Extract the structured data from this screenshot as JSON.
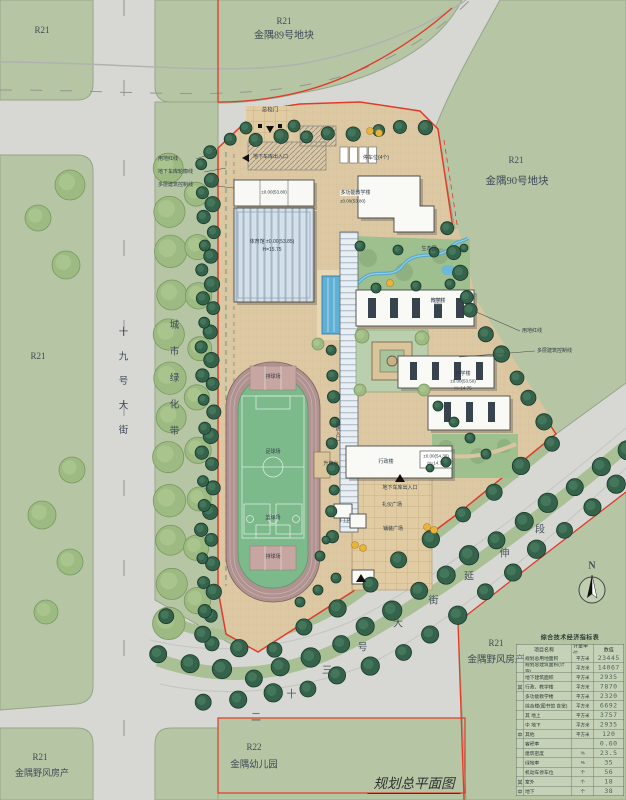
{
  "title": "规划总平面图",
  "compass": "N",
  "parcels": {
    "tl_code": "R21",
    "p89_code": "R21",
    "p89_name": "金隅89号地块",
    "p90_code": "R21",
    "p90_name": "金隅90号地块",
    "ml_code": "R21",
    "bl_code": "R21",
    "bl_name": "金隅野风房产",
    "r22_code": "R22",
    "r22_name": "金隅幼儿园",
    "br_code": "R21",
    "br_name": "金隅野风房产"
  },
  "streets": {
    "west": "十九号大街",
    "belt": "城市绿化带",
    "southeast": "二十三号大街延伸段"
  },
  "callouts": {
    "l1": "用地红线",
    "l2": "地下车库轮廓线",
    "l3": "多层建筑控制线",
    "r1": "用地红线",
    "r2": "多层建筑控制线"
  },
  "site": {
    "main_gate": "总校门",
    "garage_entry": "地下车库出入口",
    "garage_entry2": "地下车库出入口",
    "parking": "停车位(4个)",
    "canteen_elev": "±0.00(53.80)",
    "gym_line1": "体育馆 ±0.00(53.85)",
    "gym_line2": "H=15.75",
    "multi_name": "多功能教学楼",
    "multi_elev": "±0.00(53.80)",
    "eco": "生态园",
    "teach1": "教学楼",
    "teach2_name": "教学楼",
    "teach2_elev": "±0.00(53.50)",
    "teach2_h": "H=14.75",
    "admin_name": "行政楼",
    "admin_elev": "±0.00(54.30)",
    "admin_h": "H=14.75",
    "fire": "消防入口",
    "flag": "升旗台",
    "vb1": "排球场",
    "soccer": "足球场",
    "bb": "篮球场",
    "vb2": "排球场",
    "plaza1": "礼仪广场",
    "plaza2": "铺装广场",
    "guard": "门卫"
  },
  "table": {
    "title": "综合技术经济指标表",
    "headers": [
      "项目名称",
      "计量单位",
      "数值"
    ],
    "rows": [
      {
        "p": "",
        "n": "规划总用地面积",
        "u": "平方米",
        "v": "23445"
      },
      {
        "p": "",
        "n": "规划总建筑面积(计容)",
        "u": "平方米",
        "v": "14067"
      },
      {
        "p": "",
        "n": "地下建筑面积",
        "u": "平方米",
        "v": "2935"
      },
      {
        "p": "其",
        "n": "行政、教学楼",
        "u": "平方米",
        "v": "7870"
      },
      {
        "p": "",
        "n": "多功能教学楼",
        "u": "平方米",
        "v": "2320"
      },
      {
        "p": "",
        "n": "综合楼(图书馆 食堂)",
        "u": "平方米",
        "v": "6692"
      },
      {
        "p": "",
        "n": "其 地上",
        "u": "平方米",
        "v": "3757"
      },
      {
        "p": "",
        "n": "中 地下",
        "u": "平方米",
        "v": "2935"
      },
      {
        "p": "中",
        "n": "其他",
        "u": "平方米",
        "v": "120"
      },
      {
        "p": "",
        "n": "容积率",
        "u": "",
        "v": "0.60"
      },
      {
        "p": "",
        "n": "建筑密度",
        "u": "%",
        "v": "23.5"
      },
      {
        "p": "",
        "n": "绿地率",
        "u": "%",
        "v": "35"
      },
      {
        "p": "",
        "n": "机动车停车位",
        "u": "个",
        "v": "56"
      },
      {
        "p": "其",
        "n": "室外",
        "u": "个",
        "v": "18"
      },
      {
        "p": "中",
        "n": "地下",
        "u": "个",
        "v": "38"
      }
    ]
  },
  "colors": {
    "road": "#d7d8d4",
    "parcel_green": "#b6c6a4",
    "campus_tan": "#dcc8a2",
    "red_line": "#e23a2a",
    "track": "#b09290",
    "field_green": "#7cb98b",
    "pool_blue": "#5fb0d5",
    "tree_dark": "#35624a",
    "tree_light": "#9cba82",
    "accent_yellow": "#e8b43c"
  }
}
